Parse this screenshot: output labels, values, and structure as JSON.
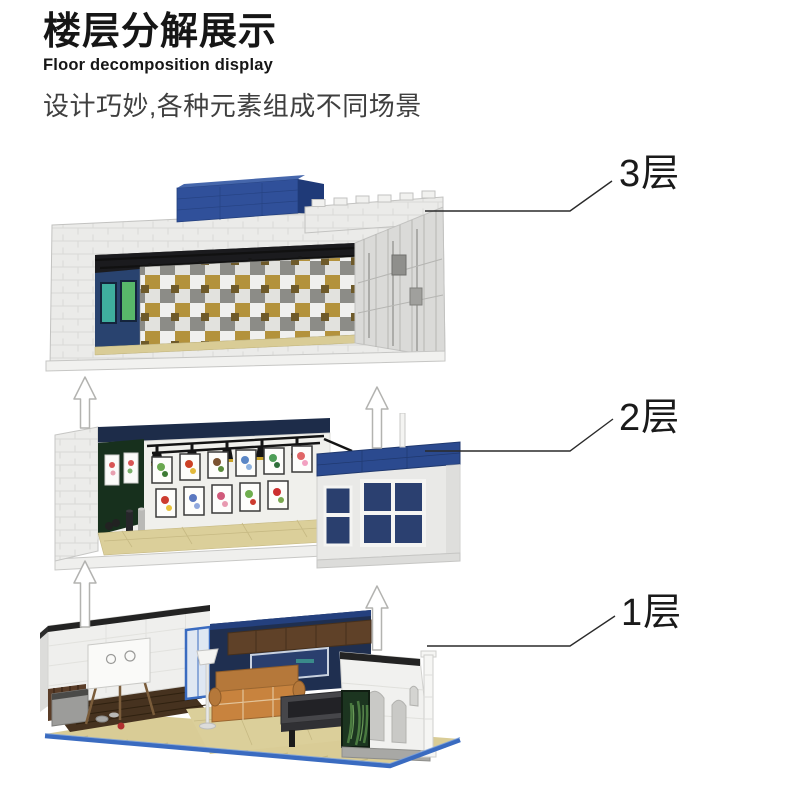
{
  "header": {
    "title_zh": "楼层分解展示",
    "title_en": "Floor decomposition display",
    "subtitle_zh": "设计巧妙,各种元素组成不同场景"
  },
  "floors": [
    {
      "label": "3层"
    },
    {
      "label": "2层"
    },
    {
      "label": "1层"
    }
  ],
  "icons": {
    "up_arrow": "↑"
  },
  "colors": {
    "heading_text": "#161616",
    "subtitle_text": "#3f3f3f",
    "label_text": "#1a1a1a",
    "leader_line": "#2a2a2a",
    "arrow_fill": "#ffffff",
    "arrow_outline": "#b3b3b0",
    "brick_white": "#ebebe9",
    "brick_blue": "#30509a",
    "cornice_blue": "#2b4a8f",
    "interior_navy": "#1f2f50",
    "floor_tan": "#d9cc96",
    "baseplate_blue": "#3a6bc0",
    "sofa_orange": "#c8833e",
    "plant_green": "#1c3520"
  }
}
